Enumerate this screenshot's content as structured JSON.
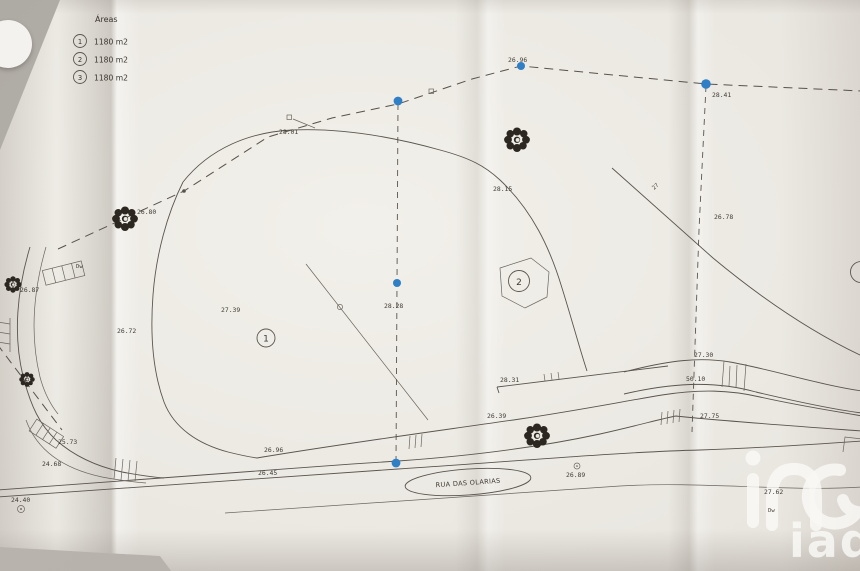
{
  "legend": {
    "title": "Áreas",
    "items": [
      {
        "num": "1",
        "area": "1180 m2"
      },
      {
        "num": "2",
        "area": "1180 m2"
      },
      {
        "num": "3",
        "area": "1180 m2"
      }
    ]
  },
  "street": {
    "name": "RUA DAS OLARIAS"
  },
  "parcels": {
    "p1": "1",
    "p2": "2",
    "p3": "3"
  },
  "watermark": {
    "brand": "iad"
  },
  "colors": {
    "ink": "#5a554e",
    "survey_point_blue": "#2e7fc6",
    "paper": "#ebe8e2",
    "background": "#b2ada7"
  },
  "labels": [
    {
      "text": "26.87"
    },
    {
      "text": "26.72"
    },
    {
      "text": "26.80"
    },
    {
      "text": "27.39"
    },
    {
      "text": "28.01"
    },
    {
      "text": "28.28"
    },
    {
      "text": "28.15"
    },
    {
      "text": "26.96"
    },
    {
      "text": "28.41"
    },
    {
      "text": "26.78"
    },
    {
      "text": "27.30"
    },
    {
      "text": "50.10"
    },
    {
      "text": "27.75"
    },
    {
      "text": "28.31"
    },
    {
      "text": "26.39"
    },
    {
      "text": "26.96"
    },
    {
      "text": "26.45"
    },
    {
      "text": "25.73"
    },
    {
      "text": "24.68"
    },
    {
      "text": "24.40"
    },
    {
      "text": "26.89"
    },
    {
      "text": "27.62"
    },
    {
      "text": "Dw"
    },
    {
      "text": "Dw"
    },
    {
      "text": "27"
    }
  ]
}
